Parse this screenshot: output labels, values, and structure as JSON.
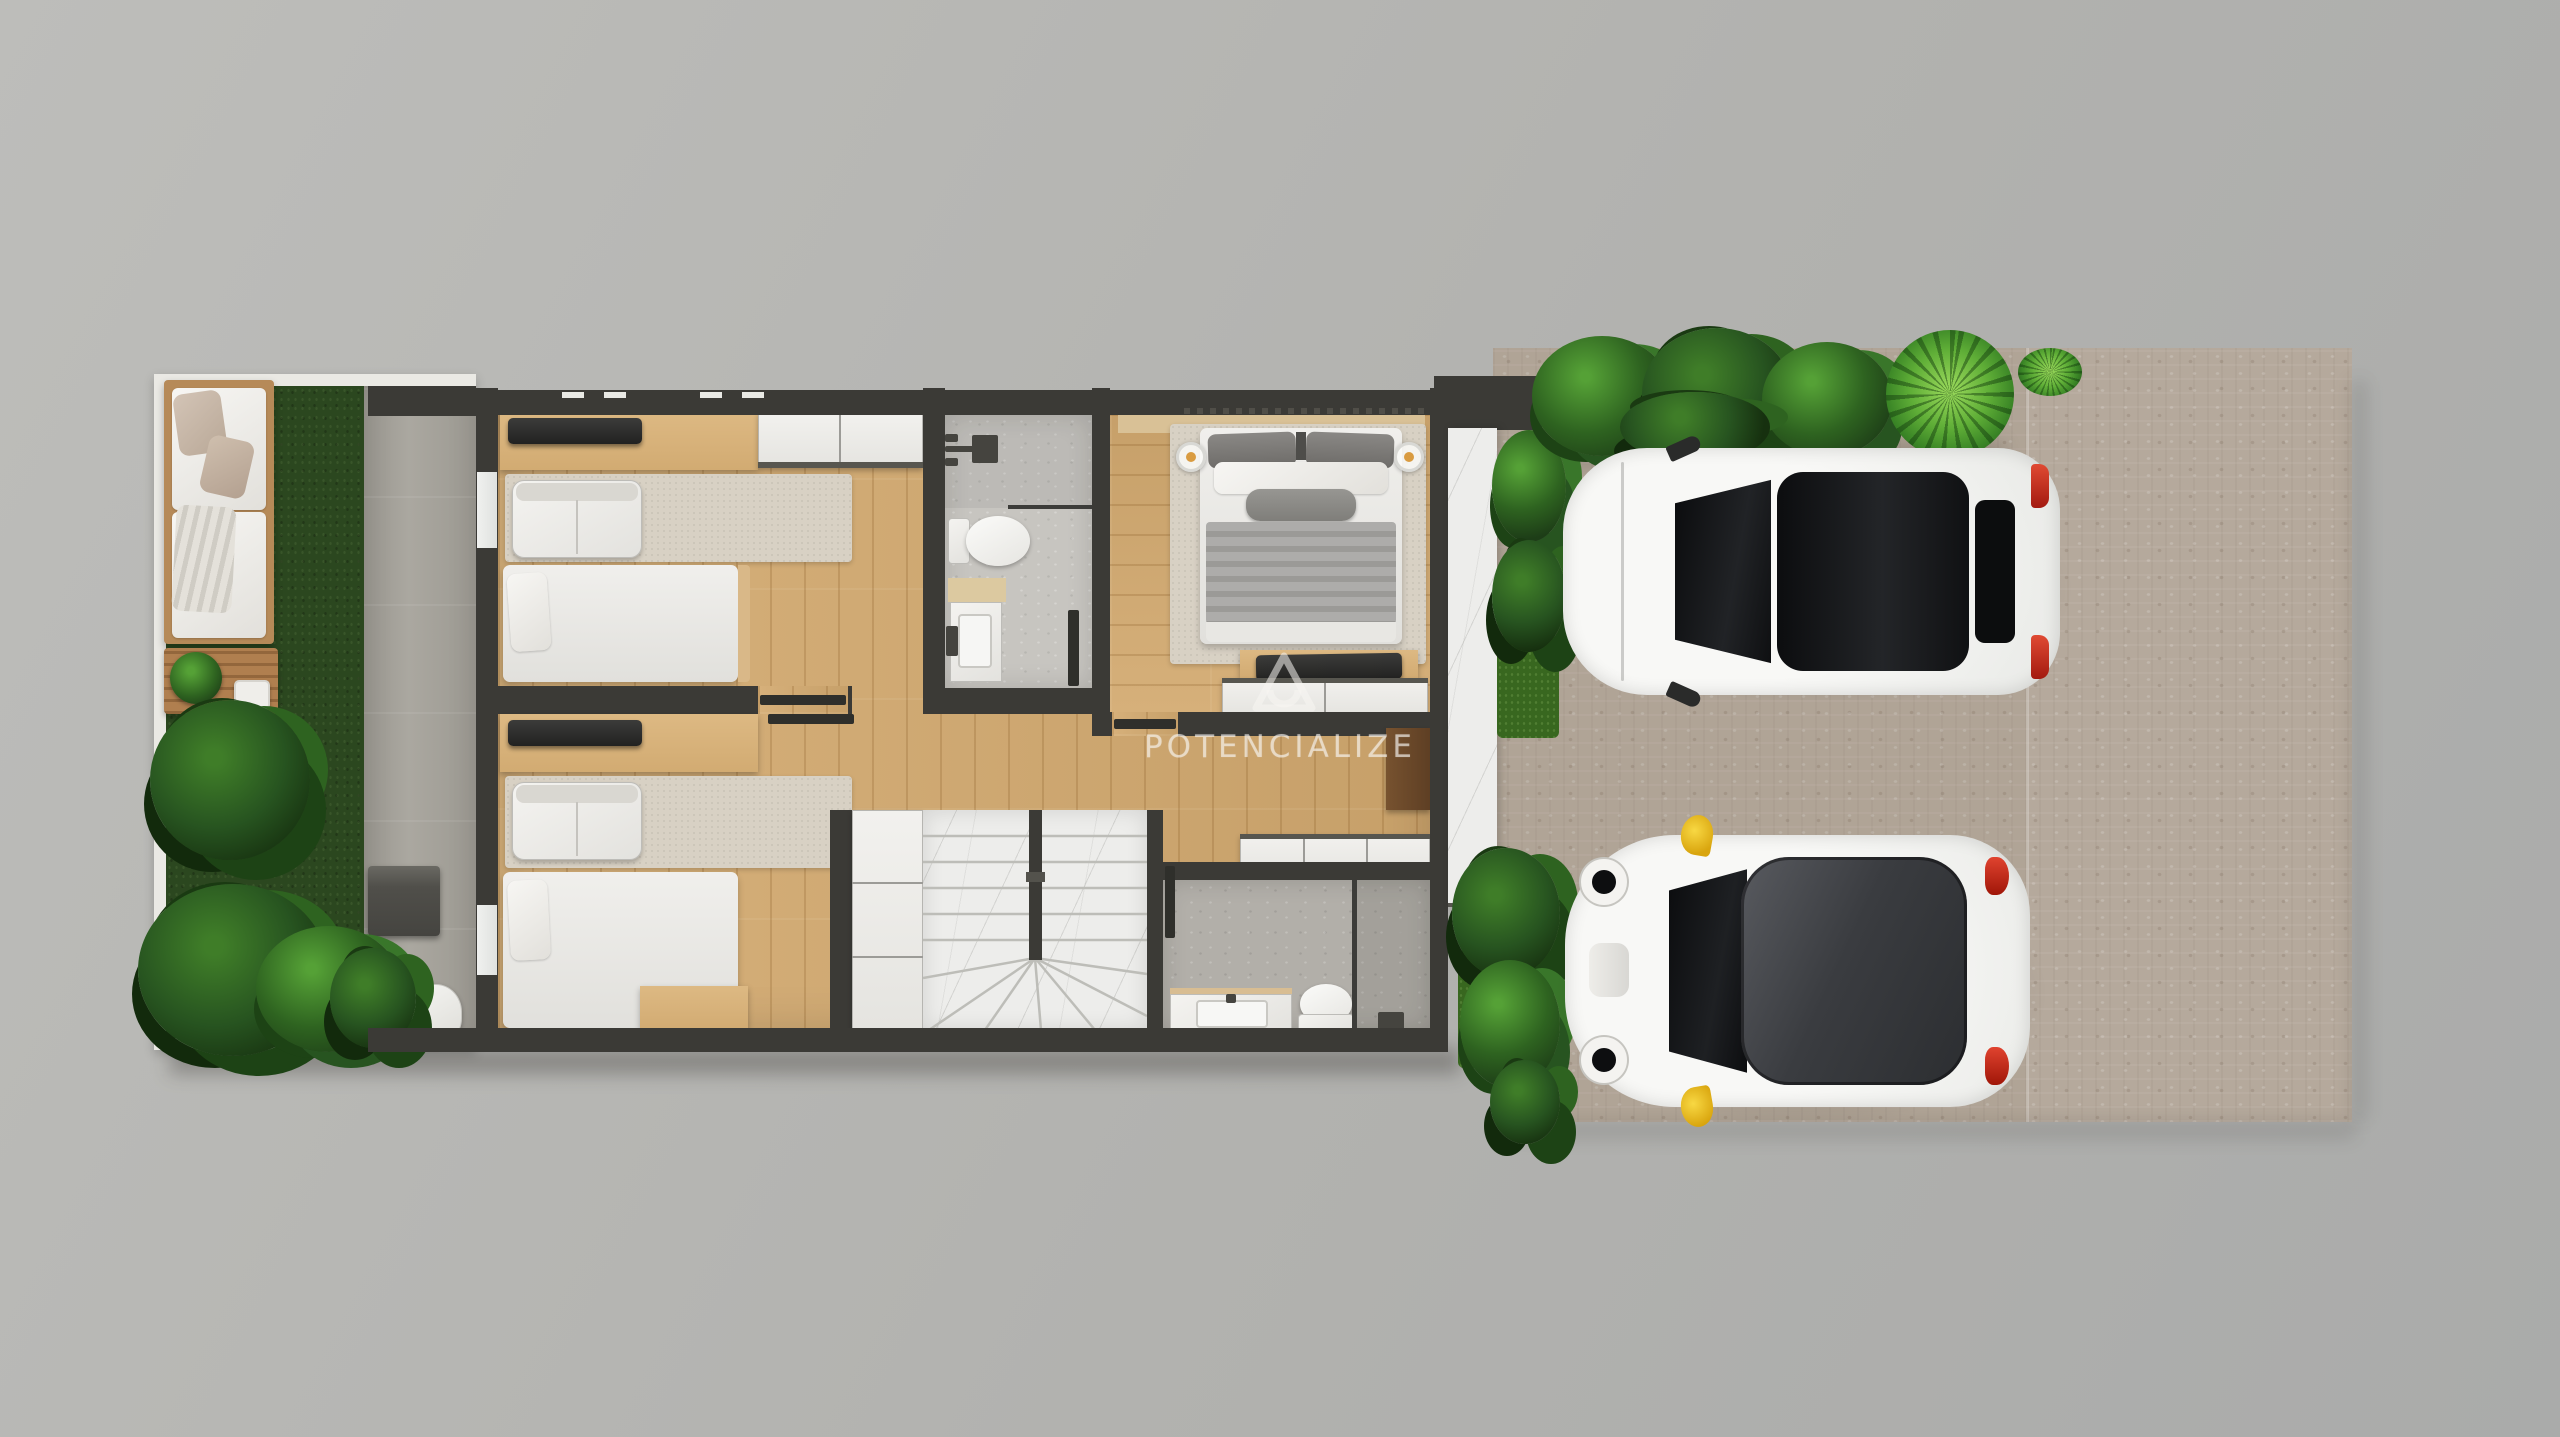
{
  "watermark": {
    "text": "POTENCIALIZE",
    "logo": "triangle-a-monogram"
  },
  "palette": {
    "background": "#b2b2af",
    "background_top": "#bdbdba",
    "background_right": "#aaabaa",
    "wall": "#3b3a36",
    "wood_floor": "#d3aa70",
    "wood_light": "#ddb983",
    "grass": "#2b471f",
    "garden_frame": "#eae9e4",
    "concrete_path": "#a6a39b",
    "rug": "#d8d1c4",
    "tile_light": "#c7c5c0",
    "tile_dark": "#b2afa9",
    "marble": "#ededeb",
    "pavement": "#b5a99c",
    "plant_dark": "#1d3d17",
    "plant_mid": "#2e6320",
    "plant_bright": "#55a136",
    "car_body": "#f1f1ef",
    "car_glass": "#141517",
    "car2_roof": "#3e4043",
    "taillight_red": "#c0281f",
    "mirror_yellow": "#f2c41c",
    "watermark_color": "rgba(248,246,242,0.55)"
  },
  "scene": {
    "type": "architectural-floor-plan-top-view-render",
    "areas": [
      "garden-terrace",
      "bedroom-1",
      "bedroom-2",
      "bathroom-1",
      "master-bedroom",
      "hallway",
      "staircase",
      "bathroom-2",
      "entry-walkway",
      "driveway"
    ],
    "vehicles": [
      "white-hatchback",
      "white-mini-dark-roof"
    ]
  }
}
